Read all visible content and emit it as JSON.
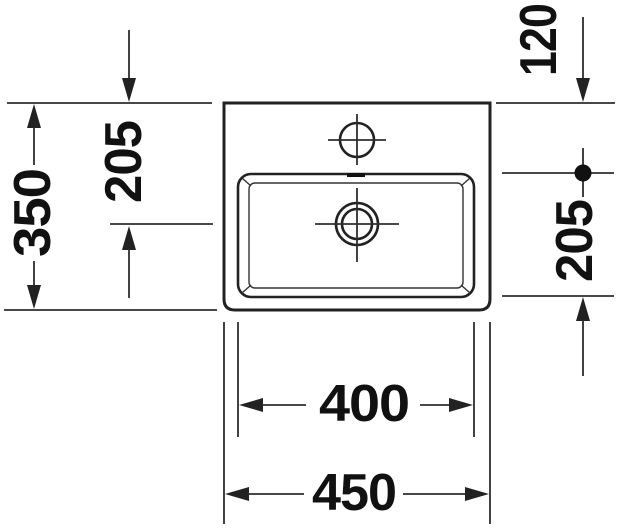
{
  "drawing": {
    "kind": "washbasin-top-view-dimension-drawing",
    "dimensions": {
      "total_depth": "350",
      "rear_to_drain_center": "205",
      "rear_edge_to_bowl": "120",
      "bowl_depth": "205",
      "bowl_width": "400",
      "total_width": "450"
    },
    "colors": {
      "background": "#ffffff",
      "line": "#2e2e2e",
      "outline": "#222222",
      "text": "#111111"
    }
  }
}
